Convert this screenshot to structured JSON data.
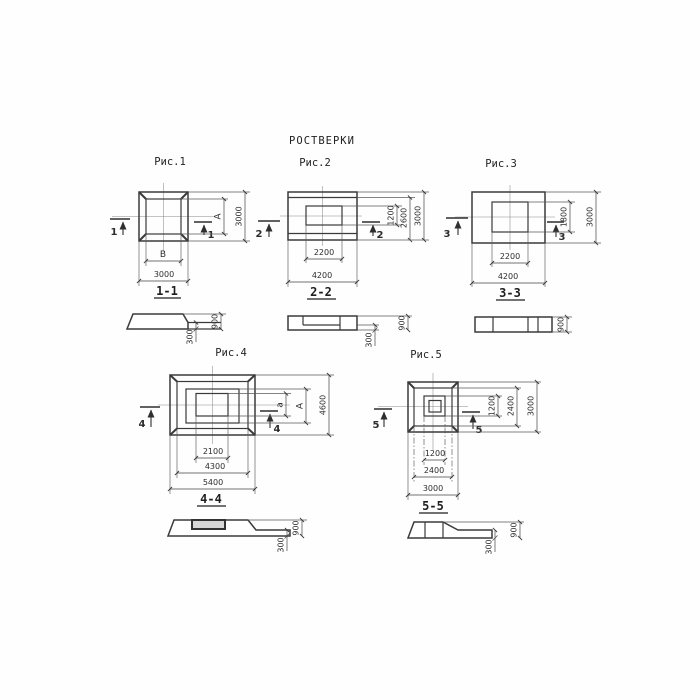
{
  "title": "РОСТВЕРКИ",
  "colors": {
    "ink": "#3a3a3a",
    "paper": "#ffffff"
  },
  "fig1": {
    "label": "Рис.1",
    "mark": "1",
    "section_label": "1-1",
    "dim_inner_width": "В",
    "dim_outer_width": "3000",
    "dim_inner_height": "А",
    "dim_outer_height": "3000"
  },
  "fig2": {
    "label": "Рис.2",
    "mark": "2",
    "section_label": "2-2",
    "dim_inner_width": "2200",
    "dim_outer_width": "4200",
    "dim_inner_height": "1200",
    "dim_mid_height": "2600",
    "dim_outer_height": "3000"
  },
  "fig3": {
    "label": "Рис.3",
    "mark": "3",
    "section_label": "3-3",
    "dim_inner_width": "2200",
    "dim_outer_width": "4200",
    "dim_inner_height": "1800",
    "dim_outer_height": "3000"
  },
  "fig4": {
    "label": "Рис.4",
    "mark": "4",
    "section_label": "4-4",
    "dim_inner_width": "2100",
    "dim_mid_width": "4300",
    "dim_outer_width": "5400",
    "dim_inner_height": "а",
    "dim_mid_height": "А",
    "dim_outer_height": "4600"
  },
  "fig5": {
    "label": "Рис.5",
    "mark": "5",
    "section_label": "5-5",
    "dim_inner_width": "1200",
    "dim_mid_width": "2400",
    "dim_outer_width": "3000",
    "dim_inner_height": "1200",
    "dim_mid_height": "2400",
    "dim_outer_height": "3000"
  },
  "sec1": {
    "dim_total": "900",
    "dim_slab": "300"
  },
  "sec2": {
    "dim_total": "900",
    "dim_slab": "300"
  },
  "sec3": {
    "dim_total": "900"
  },
  "sec4": {
    "dim_total": "900",
    "dim_slab": "300"
  },
  "sec5": {
    "dim_total": "900",
    "dim_slab": "300"
  }
}
